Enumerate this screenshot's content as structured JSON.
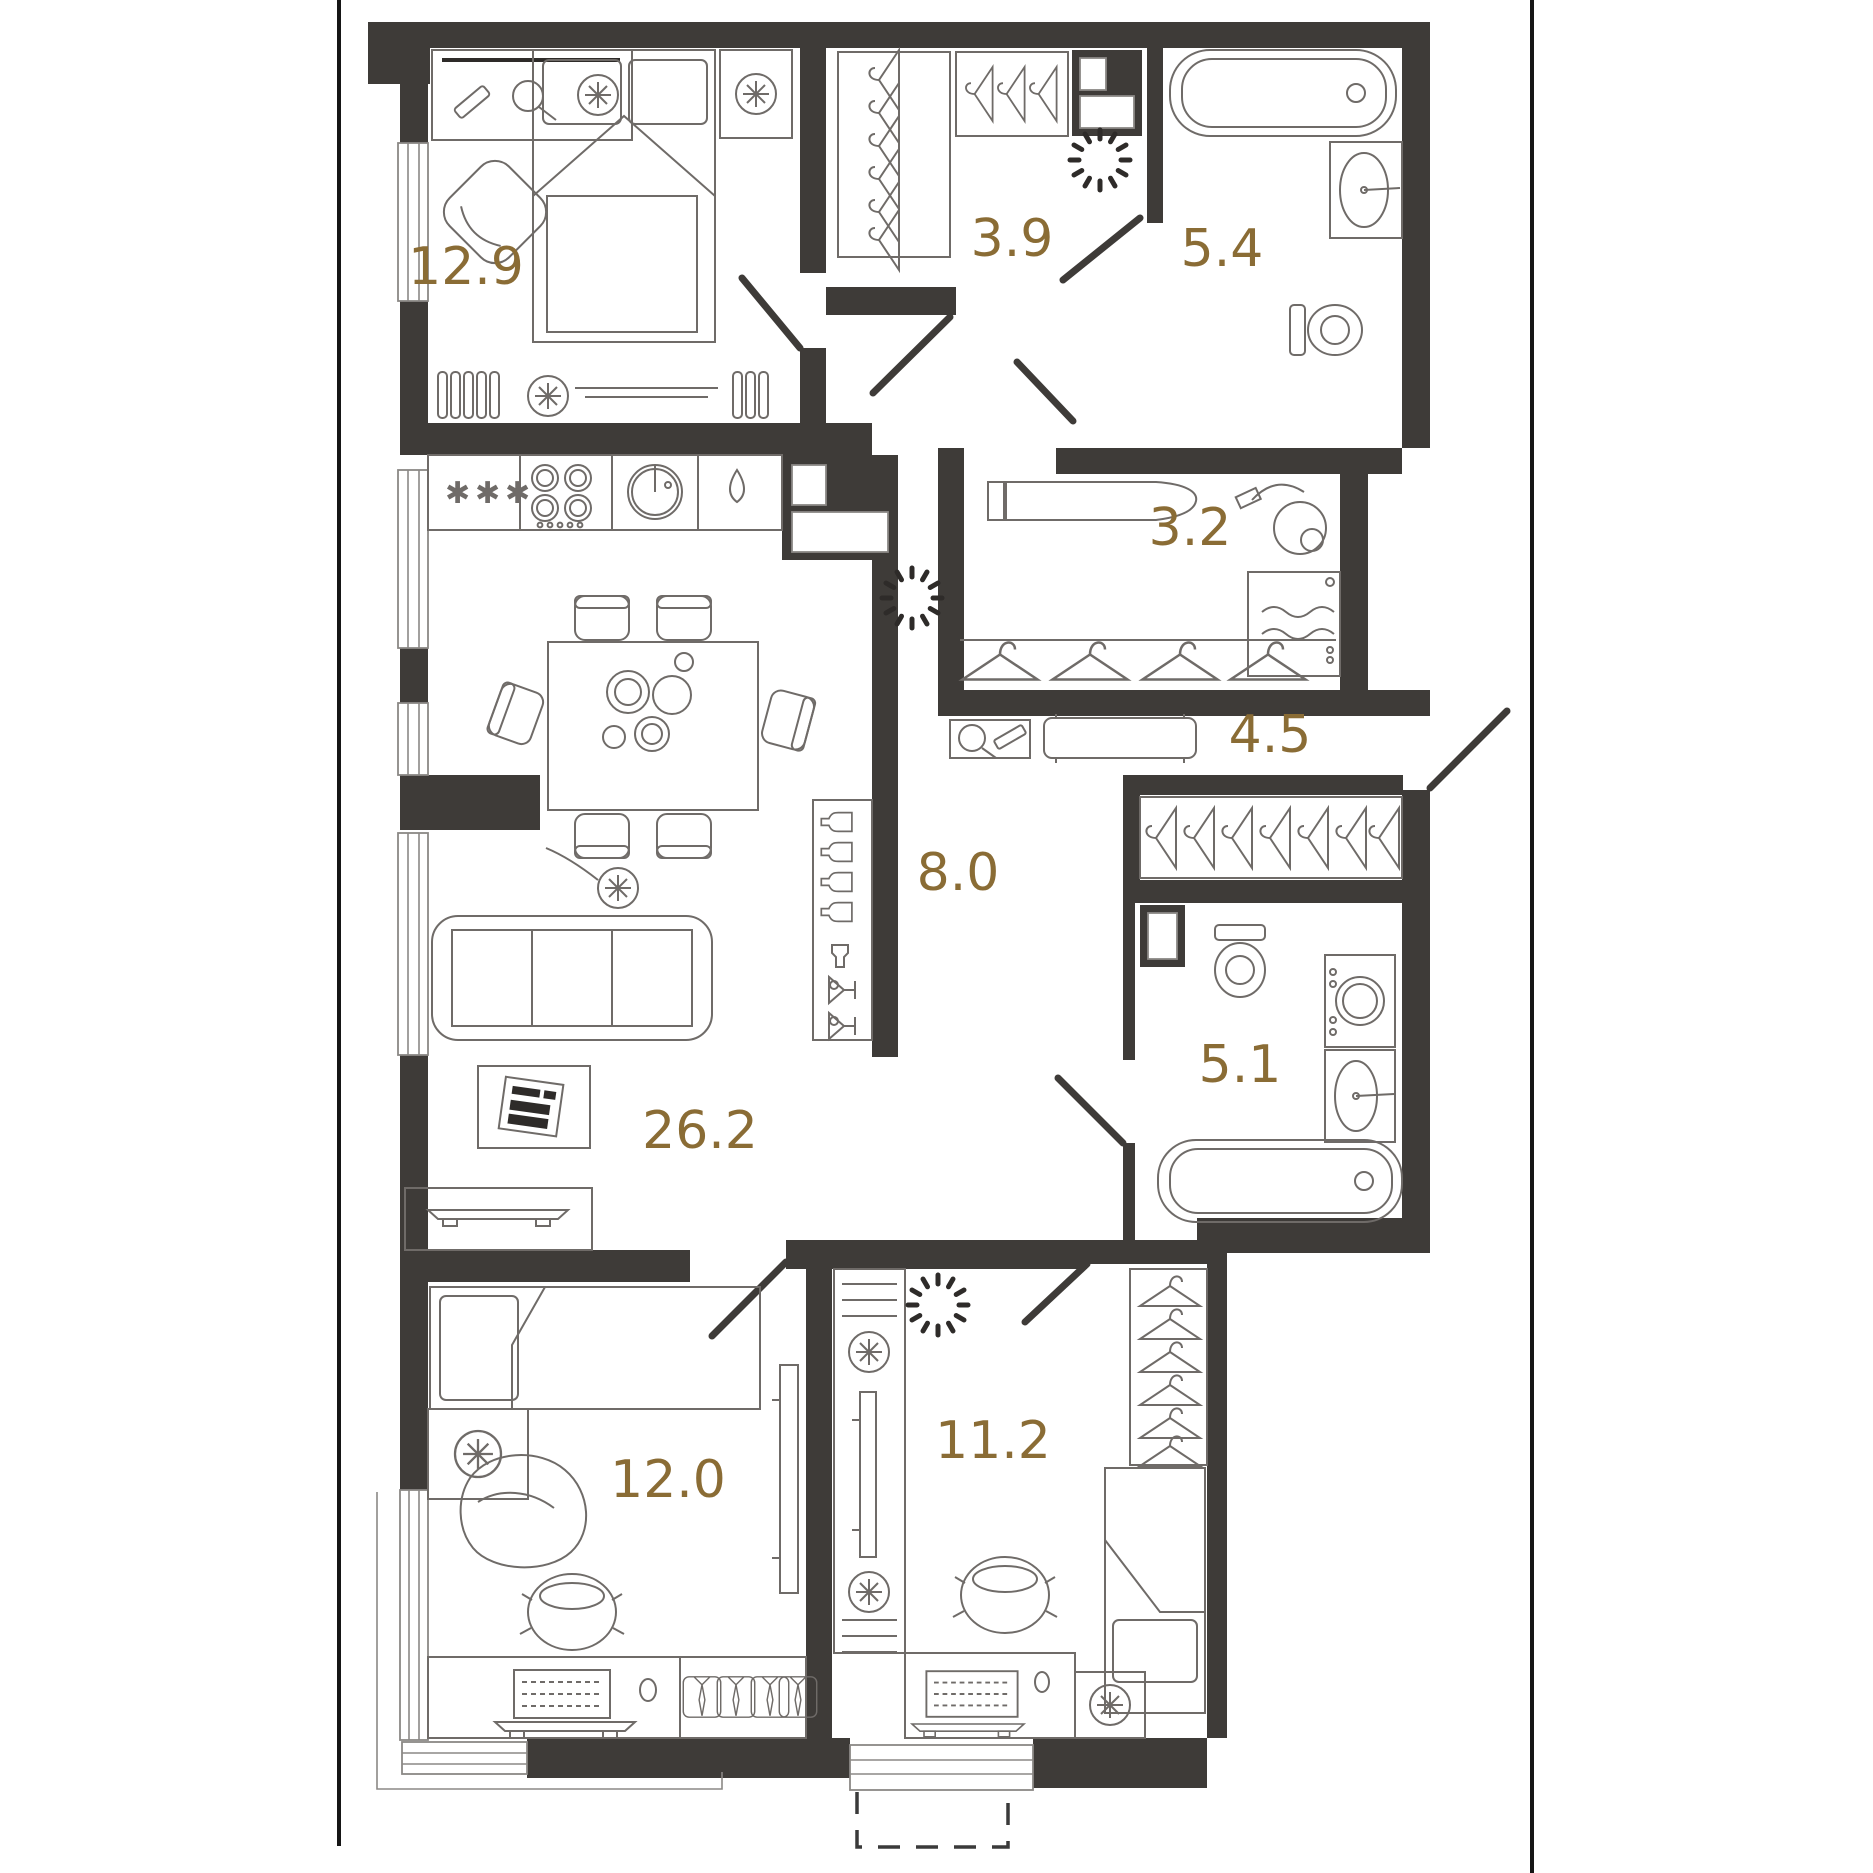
{
  "floor_plan": {
    "accent_color": "#8a6c35",
    "wall_color": "#3E3B38",
    "furniture_line_color": "#6f6b68",
    "background_color": "#ffffff",
    "rooms": [
      {
        "id": "bedroom-main",
        "area": "12.9"
      },
      {
        "id": "wardrobe",
        "area": "3.9"
      },
      {
        "id": "bathroom-main",
        "area": "5.4"
      },
      {
        "id": "utility",
        "area": "3.2"
      },
      {
        "id": "hallway",
        "area": "4.5"
      },
      {
        "id": "corridor",
        "area": "8.0"
      },
      {
        "id": "bathroom-second",
        "area": "5.1"
      },
      {
        "id": "living-kitchen",
        "area": "26.2"
      },
      {
        "id": "kids-room",
        "area": "12.0"
      },
      {
        "id": "bedroom-second",
        "area": "11.2"
      }
    ]
  }
}
